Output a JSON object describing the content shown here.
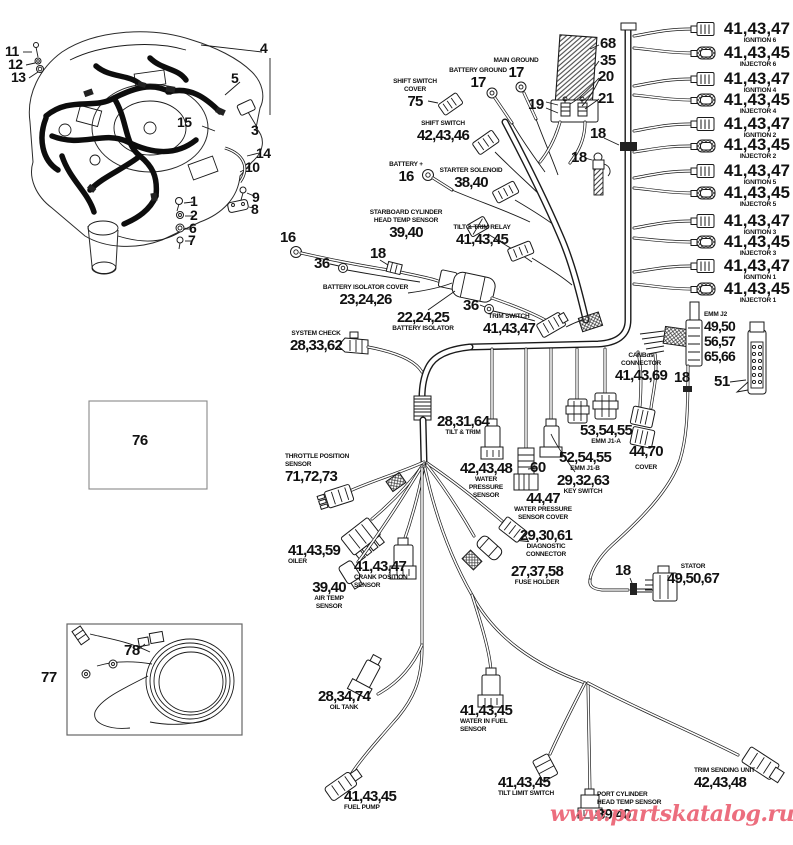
{
  "watermark": "www.partskatalog.ru",
  "colors": {
    "ink": "#1a1a1a",
    "watermark": "#ec6e7e",
    "ref_box_border": "#888888"
  },
  "right_column": [
    {
      "num": "41,43,47",
      "cap": "IGNITION 6"
    },
    {
      "num": "41,43,45",
      "cap": "INJECTOR 6"
    },
    {
      "num": "41,43,47",
      "cap": "IGNITION 4"
    },
    {
      "num": "41,43,45",
      "cap": "INJECTOR 4"
    },
    {
      "num": "41,43,47",
      "cap": "IGNITION 2"
    },
    {
      "num": "41,43,45",
      "cap": "INJECTOR 2"
    },
    {
      "num": "41,43,47",
      "cap": "IGNITION 5"
    },
    {
      "num": "41,43,45",
      "cap": "INJECTOR 5"
    },
    {
      "num": "41,43,47",
      "cap": "IGNITION 3"
    },
    {
      "num": "41,43,45",
      "cap": "INJECTOR 3"
    },
    {
      "num": "41,43,47",
      "cap": "IGNITION 1"
    },
    {
      "num": "41,43,45",
      "cap": "INJECTOR 1"
    }
  ],
  "labels": {
    "main_ground": {
      "cap": "MAIN GROUND",
      "num": "17"
    },
    "battery_ground": {
      "cap": "BATTERY GROUND",
      "num": "17"
    },
    "shift_switch_cover": {
      "cap": "SHIFT SWITCH\nCOVER",
      "num": "75"
    },
    "shift_switch": {
      "cap": "SHIFT SWITCH",
      "num": "42,43,46"
    },
    "battery_plus": {
      "cap": "BATTERY +",
      "num": "16"
    },
    "starter_solenoid": {
      "cap": "STARTER SOLENOID",
      "num": "38,40"
    },
    "starboard_head_temp": {
      "cap": "STARBOARD CYLINDER\nHEAD TEMP SENSOR",
      "num": "39,40"
    },
    "tilt_trim_relay": {
      "cap": "TILT & TRIM RELAY",
      "num": "41,43,45"
    },
    "battery_isolator_cover": {
      "cap": "BATTERY ISOLATOR COVER",
      "num": "23,24,26"
    },
    "battery_isolator": {
      "num": "22,24,25",
      "cap": "BATTERY ISOLATOR"
    },
    "trim_switch": {
      "cap": "TRIM SWITCH",
      "num": "41,43,47"
    },
    "system_check": {
      "cap": "SYSTEM CHECK",
      "num": "28,33,62"
    },
    "emm_j2": {
      "cap": "EMM J2",
      "num": "49,50\n56,57\n65,66"
    },
    "canbus": {
      "cap": "CANBus\nCONNECTOR",
      "num": "41,43,69"
    },
    "emm_j1a": {
      "num": "53,54,55",
      "cap": "EMM J1-A"
    },
    "emm_j1b": {
      "num": "52,54,55",
      "cap": "EMM J1-B"
    },
    "cover": {
      "num": "44,70",
      "cap": "COVER"
    },
    "key_switch": {
      "num": "29,32,63",
      "cap": "KEY SWITCH"
    },
    "tilt_trim": {
      "num": "28,31,64",
      "cap": "TILT & TRIM"
    },
    "water_pressure_sensor": {
      "num": "42,43,48",
      "cap": "WATER\nPRESSURE\nSENSOR"
    },
    "water_pressure_cover": {
      "num": "44,47",
      "cap": "WATER PRESSURE\nSENSOR COVER"
    },
    "diagnostic": {
      "num": "29,30,61",
      "cap": "DIAGNOSTIC\nCONNECTOR"
    },
    "throttle_position": {
      "cap": "THROTTLE POSITION\nSENSOR",
      "num": "71,72,73"
    },
    "oiler": {
      "num": "41,43,59",
      "cap": "OILER"
    },
    "crank_position": {
      "num": "41,43,47",
      "cap": "CRANK POSITION\nSENSOR"
    },
    "air_temp": {
      "num": "39,40",
      "cap": "AIR TEMP\nSENSOR"
    },
    "fuse_holder": {
      "num": "27,37,58",
      "cap": "FUSE HOLDER"
    },
    "stator": {
      "cap": "STATOR",
      "num": "49,50,67"
    },
    "oil_tank": {
      "num": "28,34,74",
      "cap": "OIL TANK"
    },
    "water_in_fuel": {
      "num": "41,43,45",
      "cap": "WATER IN FUEL\nSENSOR"
    },
    "fuel_pump": {
      "num": "41,43,45",
      "cap": "FUEL PUMP"
    },
    "tilt_limit": {
      "num": "41,43,45",
      "cap": "TILT LIMIT SWITCH"
    },
    "port_head_temp": {
      "cap": "PORT CYLINDER\nHEAD TEMP SENSOR",
      "num": "39,40"
    },
    "trim_sending": {
      "cap": "TRIM SENDING UNIT",
      "num": "42,43,48"
    }
  },
  "callouts": {
    "1": "1",
    "2": "2",
    "3": "3",
    "4": "4",
    "5": "5",
    "6": "6",
    "7": "7",
    "8": "8",
    "9": "9",
    "10": "10",
    "11": "11",
    "12": "12",
    "13": "13",
    "14": "14",
    "15": "15",
    "16": "16",
    "18": "18",
    "19": "19",
    "20": "20",
    "21": "21",
    "35": "35",
    "36": "36",
    "51": "51",
    "60": "60",
    "68": "68",
    "76": "76",
    "77": "77",
    "78": "78"
  }
}
